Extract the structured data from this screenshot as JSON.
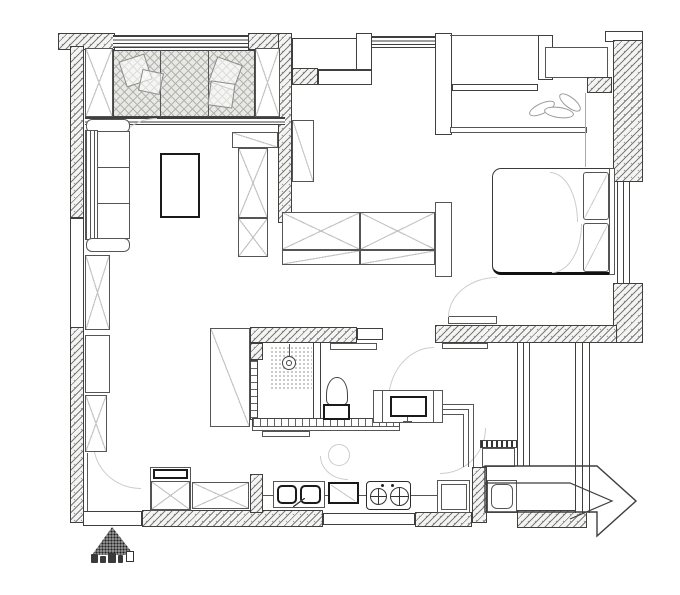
{
  "canvas": {
    "width": 680,
    "height": 595,
    "background": "#ffffff"
  },
  "palette": {
    "wall_line": "#3f3f3f",
    "furniture_line": "#555555",
    "hatch": "#7a7a7a",
    "wall_fill": "#f4f4f2",
    "deck_fill": "#e8e8e5",
    "light_detail": "#c5c5c5",
    "faint_arc": "#cccccc"
  },
  "watermark": {
    "note": "illegible-logo-stamp"
  },
  "elements": [
    {
      "n": "top-wall-left",
      "t": "wallh",
      "x": 58,
      "y": 33,
      "w": 57,
      "h": 17
    },
    {
      "n": "balcony-window-top",
      "t": "winh",
      "x": 113,
      "y": 35,
      "w": 139,
      "h": 13
    },
    {
      "n": "top-wall-mid",
      "t": "wallh",
      "x": 248,
      "y": 33,
      "w": 44,
      "h": 17
    },
    {
      "n": "divider-wall",
      "t": "wallh",
      "x": 278,
      "y": 33,
      "w": 14,
      "h": 190
    },
    {
      "n": "flue-niche",
      "t": "wallw",
      "x": 292,
      "y": 38,
      "w": 75,
      "h": 32
    },
    {
      "n": "flue-wall",
      "t": "wallh",
      "x": 292,
      "y": 68,
      "w": 26,
      "h": 17
    },
    {
      "n": "flue-step",
      "t": "wallw",
      "x": 318,
      "y": 70,
      "w": 54,
      "h": 15
    },
    {
      "n": "pier-a",
      "t": "wallw",
      "x": 356,
      "y": 33,
      "w": 16,
      "h": 37
    },
    {
      "n": "hall-window",
      "t": "winh",
      "x": 372,
      "y": 36,
      "w": 65,
      "h": 12
    },
    {
      "n": "pier-b",
      "t": "wallw",
      "x": 435,
      "y": 33,
      "w": 17,
      "h": 102
    },
    {
      "n": "bay-top-line",
      "t": "lineh",
      "x": 450,
      "y": 35,
      "w": 88,
      "h": 1
    },
    {
      "n": "bay-window",
      "t": "wallw",
      "x": 452,
      "y": 84,
      "w": 86,
      "h": 7
    },
    {
      "n": "pier-c",
      "t": "wallw",
      "x": 538,
      "y": 35,
      "w": 15,
      "h": 45
    },
    {
      "n": "ac-platform",
      "t": "furn",
      "x": 545,
      "y": 47,
      "w": 63,
      "h": 31
    },
    {
      "n": "wall-seg-ne",
      "t": "wallh",
      "x": 587,
      "y": 77,
      "w": 25,
      "h": 16
    },
    {
      "n": "top-wall-right-cap",
      "t": "wallw",
      "x": 605,
      "y": 31,
      "w": 38,
      "h": 11
    },
    {
      "n": "right-wall-upper",
      "t": "wallh",
      "x": 613,
      "y": 40,
      "w": 30,
      "h": 142
    },
    {
      "n": "bedroom-side-window",
      "t": "winv",
      "x": 617,
      "y": 182,
      "w": 13,
      "h": 101
    },
    {
      "n": "right-wall-lower",
      "t": "wallh",
      "x": 613,
      "y": 283,
      "w": 30,
      "h": 60
    },
    {
      "n": "left-wall-upper",
      "t": "wallh",
      "x": 70,
      "y": 46,
      "w": 14,
      "h": 172
    },
    {
      "n": "left-wall-window",
      "t": "wallw",
      "x": 70,
      "y": 218,
      "w": 14,
      "h": 110
    },
    {
      "n": "left-wall-lower",
      "t": "wallh",
      "x": 70,
      "y": 327,
      "w": 14,
      "h": 196
    },
    {
      "n": "balcony-sill",
      "t": "winh",
      "x": 85,
      "y": 117,
      "w": 200,
      "h": 8
    },
    {
      "n": "bedroom-bottom-wall",
      "t": "wallh",
      "x": 435,
      "y": 325,
      "w": 182,
      "h": 18
    },
    {
      "n": "bathroom-top-wall",
      "t": "wallh",
      "x": 250,
      "y": 327,
      "w": 107,
      "h": 16
    },
    {
      "n": "bathroom-door-header",
      "t": "wallw",
      "x": 357,
      "y": 328,
      "w": 26,
      "h": 12
    },
    {
      "n": "bathroom-wall-corner",
      "t": "wallh",
      "x": 250,
      "y": 343,
      "w": 13,
      "h": 17
    },
    {
      "n": "bathroom-left-wall-tiles",
      "t": "tilev",
      "x": 250,
      "y": 360,
      "w": 8,
      "h": 60
    },
    {
      "n": "bathroom-partition",
      "t": "wallw",
      "x": 313,
      "y": 342,
      "w": 8,
      "h": 83
    },
    {
      "n": "bathroom-bottom-tiles",
      "t": "tileh",
      "x": 252,
      "y": 418,
      "w": 148,
      "h": 9
    },
    {
      "n": "kitchen-counter-edge",
      "t": "furn",
      "x": 252,
      "y": 426,
      "w": 148,
      "h": 5
    },
    {
      "n": "kitchen-shelf",
      "t": "furn",
      "x": 262,
      "y": 431,
      "w": 48,
      "h": 6
    },
    {
      "n": "bottom-wall-left-gap",
      "t": "wallw",
      "x": 83,
      "y": 511,
      "w": 59,
      "h": 15
    },
    {
      "n": "bottom-wall-a",
      "t": "wallh",
      "x": 142,
      "y": 510,
      "w": 181,
      "h": 17
    },
    {
      "n": "bottom-wall-window",
      "t": "wallw",
      "x": 323,
      "y": 513,
      "w": 92,
      "h": 12
    },
    {
      "n": "bottom-wall-b",
      "t": "wallh",
      "x": 415,
      "y": 512,
      "w": 57,
      "h": 15
    },
    {
      "n": "bottom-wall-entry",
      "t": "wallh",
      "x": 517,
      "y": 510,
      "w": 70,
      "h": 18
    },
    {
      "n": "kitchen-pillar",
      "t": "wallh",
      "x": 250,
      "y": 474,
      "w": 13,
      "h": 39
    },
    {
      "n": "entry-pillar",
      "t": "wallh",
      "x": 472,
      "y": 467,
      "w": 15,
      "h": 56
    },
    {
      "n": "corridor-wall-left",
      "t": "vlines",
      "x": 517,
      "y": 343,
      "w": 13,
      "h": 123
    },
    {
      "n": "corridor-wall-right",
      "t": "vlines",
      "x": 575,
      "y": 343,
      "w": 15,
      "h": 170
    },
    {
      "n": "balcony-deck",
      "t": "deck",
      "x": 113,
      "y": 50,
      "w": 142,
      "h": 67
    },
    {
      "n": "deck-divider-1",
      "t": "linev",
      "x": 160,
      "y": 50,
      "w": 1,
      "h": 67
    },
    {
      "n": "deck-divider-2",
      "t": "linev",
      "x": 208,
      "y": 50,
      "w": 1,
      "h": 67
    },
    {
      "n": "balcony-cabinet-left",
      "t": "xbox",
      "x": 85,
      "y": 48,
      "w": 28,
      "h": 69
    },
    {
      "n": "balcony-cabinet-right",
      "t": "xbox",
      "x": 255,
      "y": 48,
      "w": 25,
      "h": 69
    },
    {
      "n": "lounge-chair-1",
      "t": "rotbox",
      "x": 122,
      "y": 57,
      "w": 27,
      "h": 27,
      "r": -18
    },
    {
      "n": "lounge-cushion-1",
      "t": "rotbox",
      "x": 140,
      "y": 71,
      "w": 22,
      "h": 22,
      "r": 12
    },
    {
      "n": "lounge-chair-2",
      "t": "rotbox",
      "x": 212,
      "y": 60,
      "w": 27,
      "h": 27,
      "r": 20
    },
    {
      "n": "lounge-cushion-2",
      "t": "rotbox",
      "x": 209,
      "y": 82,
      "w": 25,
      "h": 25,
      "r": 8
    },
    {
      "n": "door-arc-balcony",
      "t": "arc",
      "x": 113,
      "y": 118,
      "w": 44,
      "h": 40,
      "c": "tl"
    },
    {
      "n": "door-arc-living",
      "t": "arc",
      "x": 93,
      "y": 443,
      "w": 48,
      "h": 46,
      "c": "bl"
    },
    {
      "n": "door-arc-hall",
      "t": "arc",
      "x": 388,
      "y": 347,
      "w": 46,
      "h": 54,
      "c": "tl"
    },
    {
      "n": "door-arc-kitchen",
      "t": "arc",
      "x": 440,
      "y": 428,
      "w": 46,
      "h": 46,
      "c": "br"
    },
    {
      "n": "sofa-arm-top",
      "t": "furnr",
      "x": 86,
      "y": 119,
      "w": 44,
      "h": 14
    },
    {
      "n": "sofa-back",
      "t": "linesv",
      "x": 85,
      "y": 130,
      "w": 13,
      "h": 110
    },
    {
      "n": "sofa-cushion-1",
      "t": "furn",
      "x": 97,
      "y": 131,
      "w": 33,
      "h": 37
    },
    {
      "n": "sofa-cushion-2",
      "t": "furn",
      "x": 97,
      "y": 167,
      "w": 33,
      "h": 37
    },
    {
      "n": "sofa-cushion-3",
      "t": "furn",
      "x": 97,
      "y": 203,
      "w": 33,
      "h": 36
    },
    {
      "n": "sofa-arm-bottom",
      "t": "furnr",
      "x": 86,
      "y": 238,
      "w": 44,
      "h": 14
    },
    {
      "n": "coffee-table",
      "t": "furn2",
      "x": 160,
      "y": 153,
      "w": 40,
      "h": 65
    },
    {
      "n": "tv-console-top",
      "t": "dbox",
      "x": 232,
      "y": 132,
      "w": 46,
      "h": 16,
      "d": "b"
    },
    {
      "n": "tv-cabinet-upper",
      "t": "xbox",
      "x": 238,
      "y": 148,
      "w": 30,
      "h": 70
    },
    {
      "n": "tv-cabinet-lower",
      "t": "xbox",
      "x": 238,
      "y": 218,
      "w": 30,
      "h": 39
    },
    {
      "n": "hall-shaft",
      "t": "dbox",
      "x": 292,
      "y": 120,
      "w": 22,
      "h": 62,
      "d": "b"
    },
    {
      "n": "side-cabinet-1",
      "t": "xbox",
      "x": 85,
      "y": 255,
      "w": 25,
      "h": 75
    },
    {
      "n": "side-cabinet-2",
      "t": "furn",
      "x": 85,
      "y": 335,
      "w": 25,
      "h": 58
    },
    {
      "n": "side-cabinet-3",
      "t": "xbox",
      "x": 85,
      "y": 395,
      "w": 22,
      "h": 57
    },
    {
      "n": "side-cabinet-line",
      "t": "linev",
      "x": 87,
      "y": 453,
      "w": 1,
      "h": 58
    },
    {
      "n": "wardrobe-left",
      "t": "xbox",
      "x": 282,
      "y": 212,
      "w": 78,
      "h": 38
    },
    {
      "n": "wardrobe-right",
      "t": "xbox",
      "x": 360,
      "y": 212,
      "w": 75,
      "h": 38
    },
    {
      "n": "wardrobe-lower-left",
      "t": "dbox",
      "x": 282,
      "y": 250,
      "w": 78,
      "h": 15,
      "d": "a"
    },
    {
      "n": "wardrobe-lower-right",
      "t": "dbox",
      "x": 360,
      "y": 250,
      "w": 75,
      "h": 15,
      "d": "a"
    },
    {
      "n": "wardrobe-end-panel",
      "t": "furn",
      "x": 435,
      "y": 202,
      "w": 17,
      "h": 75
    },
    {
      "n": "bedroom-cabinet-top",
      "t": "furn",
      "x": 450,
      "y": 127,
      "w": 137,
      "h": 6
    },
    {
      "n": "bedroom-cabinet-side-line",
      "t": "linevf",
      "x": 585,
      "y": 93,
      "w": 1,
      "h": 74
    },
    {
      "n": "plant-leaf-1",
      "t": "leaf",
      "x": 528,
      "y": 103,
      "w": 28,
      "h": 11,
      "r": -25
    },
    {
      "n": "plant-leaf-2",
      "t": "leaf",
      "x": 544,
      "y": 107,
      "w": 30,
      "h": 11,
      "r": 8
    },
    {
      "n": "plant-leaf-3",
      "t": "leaf",
      "x": 557,
      "y": 97,
      "w": 26,
      "h": 11,
      "r": 38
    },
    {
      "n": "bed",
      "t": "bed",
      "x": 492,
      "y": 168,
      "w": 118,
      "h": 107
    },
    {
      "n": "blanket-fold-1",
      "t": "arc",
      "x": 550,
      "y": 172,
      "w": 28,
      "h": 50,
      "c": "tr"
    },
    {
      "n": "blanket-fold-2",
      "t": "arc",
      "x": 552,
      "y": 224,
      "w": 30,
      "h": 49,
      "c": "br"
    },
    {
      "n": "pillow-1",
      "t": "pillow",
      "x": 583,
      "y": 172,
      "w": 26,
      "h": 48
    },
    {
      "n": "pillow-2",
      "t": "pillow",
      "x": 583,
      "y": 223,
      "w": 26,
      "h": 49
    },
    {
      "n": "headboard",
      "t": "furn",
      "x": 609,
      "y": 168,
      "w": 6,
      "h": 107
    },
    {
      "n": "bedroom-door-leaf",
      "t": "furn",
      "x": 448,
      "y": 316,
      "w": 49,
      "h": 8
    },
    {
      "n": "bedroom-door-arc",
      "t": "arc",
      "x": 448,
      "y": 277,
      "w": 49,
      "h": 40,
      "c": "tl"
    },
    {
      "n": "entry-shelf",
      "t": "furn",
      "x": 442,
      "y": 343,
      "w": 46,
      "h": 6
    },
    {
      "n": "bathroom-door-panel",
      "t": "dbox",
      "x": 210,
      "y": 328,
      "w": 40,
      "h": 99,
      "d": "b"
    },
    {
      "n": "shower-stem",
      "t": "linev",
      "x": 289,
      "y": 344,
      "w": 1,
      "h": 13
    },
    {
      "n": "shower-spray-area",
      "t": "dots",
      "x": 270,
      "y": 346,
      "w": 42,
      "h": 44
    },
    {
      "n": "shower-head",
      "t": "circ2",
      "x": 282,
      "y": 356,
      "w": 14,
      "h": 14
    },
    {
      "n": "toilet-bowl",
      "t": "toiletb",
      "x": 326,
      "y": 377,
      "w": 22,
      "h": 29
    },
    {
      "n": "toilet-tank",
      "t": "furn2",
      "x": 323,
      "y": 404,
      "w": 27,
      "h": 16
    },
    {
      "n": "vanity-counter",
      "t": "furn",
      "x": 373,
      "y": 390,
      "w": 70,
      "h": 33
    },
    {
      "n": "vanity-panel-left",
      "t": "furn",
      "x": 373,
      "y": 390,
      "w": 10,
      "h": 33
    },
    {
      "n": "vanity-panel-right",
      "t": "furn",
      "x": 433,
      "y": 390,
      "w": 10,
      "h": 33
    },
    {
      "n": "vanity-basin",
      "t": "furn2",
      "x": 390,
      "y": 396,
      "w": 37,
      "h": 21
    },
    {
      "n": "faucet-stem",
      "t": "linev",
      "x": 407,
      "y": 417,
      "w": 1,
      "h": 5
    },
    {
      "n": "faucet-bar",
      "t": "lineh",
      "x": 403,
      "y": 421,
      "w": 9,
      "h": 1
    },
    {
      "n": "vanity-shelf",
      "t": "furn",
      "x": 330,
      "y": 343,
      "w": 47,
      "h": 7
    },
    {
      "n": "counter-mid-line",
      "t": "lineh",
      "x": 263,
      "y": 495,
      "w": 207,
      "h": 1
    },
    {
      "n": "fridge-outer",
      "t": "furn",
      "x": 150,
      "y": 467,
      "w": 41,
      "h": 44
    },
    {
      "n": "fridge-top",
      "t": "furn2",
      "x": 153,
      "y": 469,
      "w": 35,
      "h": 10
    },
    {
      "n": "fridge-body",
      "t": "xbox",
      "x": 151,
      "y": 481,
      "w": 39,
      "h": 29
    },
    {
      "n": "counter-cabinet-left",
      "t": "xbox",
      "x": 192,
      "y": 482,
      "w": 57,
      "h": 27
    },
    {
      "n": "sink-counter",
      "t": "furn",
      "x": 273,
      "y": 481,
      "w": 52,
      "h": 27
    },
    {
      "n": "sink-bowl-left",
      "t": "furn2r",
      "x": 277,
      "y": 485,
      "w": 20,
      "h": 19
    },
    {
      "n": "sink-bowl-right",
      "t": "furn2r",
      "x": 300,
      "y": 485,
      "w": 21,
      "h": 19
    },
    {
      "n": "sink-faucet",
      "t": "dboxd",
      "x": 293,
      "y": 498,
      "w": 12,
      "h": 9,
      "d": "a"
    },
    {
      "n": "oven-box",
      "t": "furn2",
      "x": 328,
      "y": 482,
      "w": 31,
      "h": 22
    },
    {
      "n": "oven-detail",
      "t": "dboxf",
      "x": 331,
      "y": 485,
      "w": 24,
      "h": 16,
      "d": "b"
    },
    {
      "n": "stove",
      "t": "stove",
      "x": 366,
      "y": 481,
      "w": 45,
      "h": 29
    },
    {
      "n": "burner-1",
      "t": "burner",
      "x": 370,
      "y": 488,
      "w": 17,
      "h": 17
    },
    {
      "n": "burner-2",
      "t": "burner",
      "x": 390,
      "y": 487,
      "w": 19,
      "h": 19
    },
    {
      "n": "stove-dot-1",
      "t": "dot",
      "x": 381,
      "y": 484,
      "w": 3,
      "h": 3
    },
    {
      "n": "stove-dot-2",
      "t": "dot",
      "x": 391,
      "y": 484,
      "w": 3,
      "h": 3
    },
    {
      "n": "counter-right",
      "t": "furn",
      "x": 437,
      "y": 480,
      "w": 33,
      "h": 33
    },
    {
      "n": "counter-right-inner",
      "t": "furn",
      "x": 441,
      "y": 484,
      "w": 26,
      "h": 26
    },
    {
      "n": "corner-line-h1",
      "t": "lineh",
      "x": 443,
      "y": 404,
      "w": 30,
      "h": 1
    },
    {
      "n": "corner-line-h2",
      "t": "lineh",
      "x": 443,
      "y": 409,
      "w": 25,
      "h": 1
    },
    {
      "n": "corner-line-h3",
      "t": "lineh",
      "x": 443,
      "y": 414,
      "w": 20,
      "h": 1
    },
    {
      "n": "corner-line-v1",
      "t": "linev",
      "x": 473,
      "y": 404,
      "w": 1,
      "h": 63
    },
    {
      "n": "corner-line-v2",
      "t": "linev",
      "x": 468,
      "y": 409,
      "w": 1,
      "h": 58
    },
    {
      "n": "corner-line-v3",
      "t": "linev",
      "x": 463,
      "y": 414,
      "w": 1,
      "h": 53
    },
    {
      "n": "person-sketch",
      "t": "circf",
      "x": 328,
      "y": 444,
      "w": 22,
      "h": 22
    },
    {
      "n": "person-sketch-arc",
      "t": "arc",
      "x": 320,
      "y": 456,
      "w": 28,
      "h": 24,
      "c": "bl"
    },
    {
      "n": "shoe-rack-stripes",
      "t": "stripes",
      "x": 480,
      "y": 440,
      "w": 38,
      "h": 8
    },
    {
      "n": "shoe-cabinet",
      "t": "furn",
      "x": 482,
      "y": 448,
      "w": 33,
      "h": 19
    },
    {
      "n": "washing-machine",
      "t": "furn",
      "x": 487,
      "y": 480,
      "w": 30,
      "h": 33
    },
    {
      "n": "washing-machine-inner",
      "t": "furnr",
      "x": 491,
      "y": 484,
      "w": 22,
      "h": 25
    },
    {
      "n": "entry-arrow",
      "t": "arrow",
      "x": 478,
      "y": 448,
      "w": 170,
      "h": 92,
      "pts": "7,18 119,18 158,53 119,88 119,64 7,64",
      "chev": "7,35 92,35 134,53 92,71"
    },
    {
      "n": "watermark-triangle",
      "t": "tri",
      "x": 92,
      "y": 527,
      "w": 42,
      "h": 28
    },
    {
      "n": "watermark-glyph-1",
      "t": "blob",
      "x": 91,
      "y": 554,
      "w": 7,
      "h": 9
    },
    {
      "n": "watermark-glyph-2",
      "t": "blob",
      "x": 100,
      "y": 556,
      "w": 6,
      "h": 7
    },
    {
      "n": "watermark-glyph-3",
      "t": "blob",
      "x": 108,
      "y": 553,
      "w": 8,
      "h": 10
    },
    {
      "n": "watermark-glyph-4",
      "t": "blob",
      "x": 118,
      "y": 555,
      "w": 5,
      "h": 8
    },
    {
      "n": "watermark-glyph-box",
      "t": "blobo",
      "x": 126,
      "y": 551,
      "w": 8,
      "h": 11
    }
  ]
}
